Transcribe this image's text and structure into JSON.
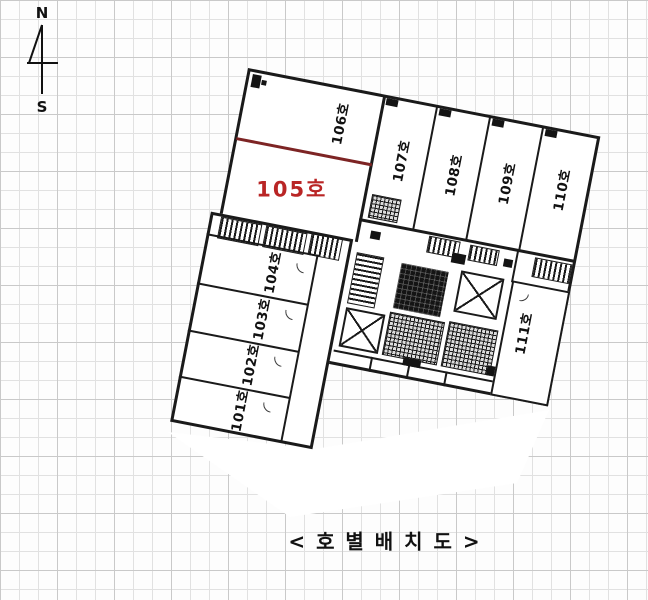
{
  "compass": {
    "north": "N",
    "south": "S"
  },
  "caption": "< 호 별 배 치 도 >",
  "plan": {
    "title": "호별배치도",
    "highlighted_room": "105호",
    "rooms": [
      {
        "label": "101호"
      },
      {
        "label": "102호"
      },
      {
        "label": "103호"
      },
      {
        "label": "104호"
      },
      {
        "label": "105호"
      },
      {
        "label": "106호"
      },
      {
        "label": "107호"
      },
      {
        "label": "108호"
      },
      {
        "label": "109호"
      },
      {
        "label": "110호"
      },
      {
        "label": "111호"
      }
    ]
  },
  "colors": {
    "wall": "#1a1a1a",
    "highlight_text": "#b92525",
    "highlight_divider": "#7d2424",
    "grid_line": "#e1e1e1",
    "paper": "#fdfdfd"
  }
}
